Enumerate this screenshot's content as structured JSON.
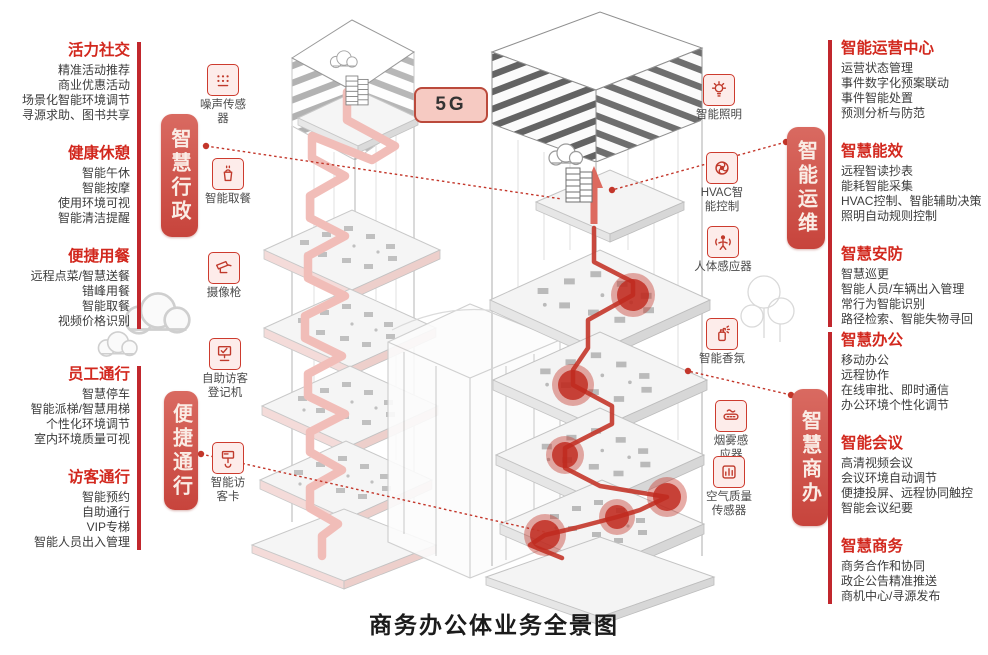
{
  "title": "商务办公体业务全景图",
  "badge_5g": "5G",
  "colors": {
    "accent_red": "#c1272d",
    "pill_red": "#c7443c",
    "pink_path": "#f0b6b1",
    "badge_bg": "#f6cac2"
  },
  "pills": {
    "admin": "智慧行政",
    "access": "便捷通行",
    "ops": "智能运维",
    "biz": "智慧商办"
  },
  "left_top": {
    "groups": [
      {
        "title": "活力社交",
        "items": [
          "精准活动推荐",
          "商业优惠活动",
          "场景化智能环境调节",
          "寻源求助、图书共享"
        ]
      },
      {
        "title": "健康休憩",
        "items": [
          "智能午休",
          "智能按摩",
          "使用环境可视",
          "智能清洁提醒"
        ]
      },
      {
        "title": "便捷用餐",
        "items": [
          "远程点菜/智慧送餐",
          "错峰用餐",
          "智能取餐",
          "视频价格识别"
        ]
      }
    ]
  },
  "left_bottom": {
    "groups": [
      {
        "title": "员工通行",
        "items": [
          "智慧停车",
          "智能派梯/智慧用梯",
          "个性化环境调节",
          "室内环境质量可视"
        ]
      },
      {
        "title": "访客通行",
        "items": [
          "智能预约",
          "自助通行",
          "VIP专梯",
          "智能人员出入管理"
        ]
      }
    ]
  },
  "right_top": {
    "groups": [
      {
        "title": "智能运营中心",
        "items": [
          "运营状态管理",
          "事件数字化预案联动",
          "事件智能处置",
          "预测分析与防范"
        ]
      },
      {
        "title": "智慧能效",
        "items": [
          "远程智读抄表",
          "能耗智能采集",
          "HVAC控制、智能辅助决策",
          "照明自动规则控制"
        ]
      },
      {
        "title": "智慧安防",
        "items": [
          "智慧巡更",
          "智能人员/车辆出入管理",
          "常行为智能识别",
          "路径检索、智能失物寻回"
        ]
      }
    ]
  },
  "right_bottom": {
    "groups": [
      {
        "title": "智慧办公",
        "items": [
          "移动办公",
          "远程协作",
          "在线审批、即时通信",
          "办公环境个性化调节"
        ]
      },
      {
        "title": "智能会议",
        "items": [
          "高清视频会议",
          "会议环境自动调节",
          "便捷投屏、远程协同触控",
          "智能会议纪要"
        ]
      },
      {
        "title": "智慧商务",
        "items": [
          "商务合作和协同",
          "政企公告精准推送",
          "商机中心/寻源发布"
        ]
      }
    ]
  },
  "sensors": [
    {
      "label": "噪声传感\n器"
    },
    {
      "label": "智能取餐"
    },
    {
      "label": "摄像枪"
    },
    {
      "label": "自助访客\n登记机"
    },
    {
      "label": "智能访\n客卡"
    },
    {
      "label": "智能照明"
    },
    {
      "label": "HVAC智\n能控制"
    },
    {
      "label": "人体感应器"
    },
    {
      "label": "智能香氛"
    },
    {
      "label": "烟雾感\n应器"
    },
    {
      "label": "空气质量\n传感器"
    }
  ]
}
